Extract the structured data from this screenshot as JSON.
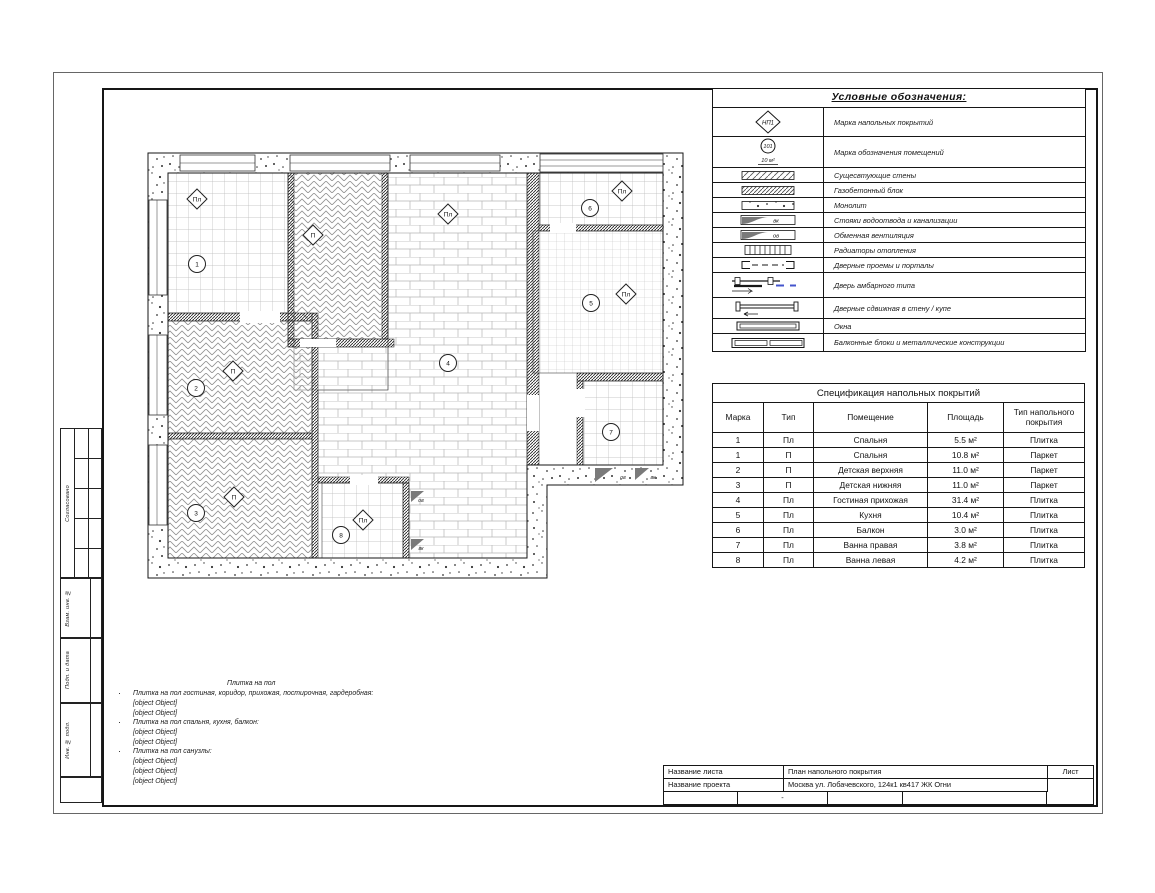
{
  "legend": {
    "title": "Условные обозначения:",
    "rows": [
      {
        "symbol": "floor-mark",
        "sym_text": "НП1",
        "label": "Марка напольных покрытий"
      },
      {
        "symbol": "room-mark",
        "sym_text": "101",
        "sym_sub": "10 м²",
        "label": "Марка обозначения помещений"
      },
      {
        "symbol": "existing-walls",
        "label": "Сущесвтующие стены"
      },
      {
        "symbol": "gas-block",
        "label": "Газобетонный блок"
      },
      {
        "symbol": "monolith",
        "label": "Монолит"
      },
      {
        "symbol": "water-stack",
        "sym_text": "вк",
        "label": "Стояки водоотвода и канализации"
      },
      {
        "symbol": "vent",
        "sym_text": "ов",
        "label": "Обменная вентиляция"
      },
      {
        "symbol": "radiator",
        "label": "Радиаторы отопления"
      },
      {
        "symbol": "door-opening",
        "label": "Дверные проемы и порталы"
      },
      {
        "symbol": "barn-door",
        "label": "Дверь амбарного типа"
      },
      {
        "symbol": "sliding-door",
        "label": "Дверные сдвижная в стену / купе"
      },
      {
        "symbol": "window",
        "label": "Окна"
      },
      {
        "symbol": "balcony-block",
        "label": "Балконные блоки и металлические конструкции"
      }
    ]
  },
  "spec": {
    "title": "Спецификация напольных покрытий",
    "headers": [
      "Марка",
      "Тип",
      "Помещение",
      "Площадь",
      "Тип напольного покрытия"
    ],
    "rows": [
      [
        "1",
        "Пл",
        "Спальня",
        "5.5 м²",
        "Плитка"
      ],
      [
        "1",
        "П",
        "Спальня",
        "10.8 м²",
        "Паркет"
      ],
      [
        "2",
        "П",
        "Детская верхняя",
        "11.0 м²",
        "Паркет"
      ],
      [
        "3",
        "П",
        "Детская нижняя",
        "11.0 м²",
        "Паркет"
      ],
      [
        "4",
        "Пл",
        "Гостиная прихожая",
        "31.4 м²",
        "Плитка"
      ],
      [
        "5",
        "Пл",
        "Кухня",
        "10.4 м²",
        "Плитка"
      ],
      [
        "6",
        "Пл",
        "Балкон",
        "3.0 м²",
        "Плитка"
      ],
      [
        "7",
        "Пл",
        "Ванна правая",
        "3.8 м²",
        "Плитка"
      ],
      [
        "8",
        "Пл",
        "Ванна левая",
        "4.2 м²",
        "Плитка"
      ]
    ]
  },
  "notes": {
    "title": "Плитка на пол",
    "items": [
      {
        "text": "Плитка на пол гостиная, коридор, прихожая, постирочная, гардеробная:",
        "lines": [
          "https://kerama-marazzi.com/catalog/gres/sg701390r/",
          "9 мм"
        ]
      },
      {
        "text": "Плитка на пол спальня, кухня, балкон:",
        "lines": [
          "https://plitkazavr.ru/Italon/Climb/Rope-60x60",
          "9 мм"
        ]
      },
      {
        "text": "Плитка на пол санузлы:",
        "lines": [
          "https://laparet.ru/collection/amber_keramogranit_bezhevyy_sg162700n_40_2kh40_2/",
          "https://creto.ru/produkt/keramogranit-urban-chrome-f-p-47x47-nr-mat-1",
          "8мм"
        ]
      }
    ]
  },
  "titleblock": {
    "sheet_label": "Название листа",
    "sheet_value": "План напольного покрытия",
    "project_label": "Название проекта",
    "project_value": "Москва ул. Лобачевского, 124к1 кв417 ЖК Огни",
    "list_label": "Лист",
    "dash": "-"
  },
  "stamp": {
    "sections": [
      "Согласовано",
      "Взам. инв. №",
      "Подп. и дата",
      "Инв. № подл."
    ]
  },
  "plan": {
    "markers": [
      {
        "shape": "diamond",
        "label": "Пл"
      },
      {
        "shape": "circle",
        "label": "1"
      },
      {
        "shape": "diamond",
        "label": "П"
      },
      {
        "shape": "diamond",
        "label": "Пл"
      },
      {
        "shape": "circle",
        "label": "4"
      },
      {
        "shape": "diamond",
        "label": "Пл"
      },
      {
        "shape": "circle",
        "label": "6"
      },
      {
        "shape": "circle",
        "label": "5"
      },
      {
        "shape": "diamond",
        "label": "Пл"
      },
      {
        "shape": "diamond",
        "label": "П"
      },
      {
        "shape": "circle",
        "label": "2"
      },
      {
        "shape": "diamond",
        "label": "П"
      },
      {
        "shape": "circle",
        "label": "3"
      },
      {
        "shape": "diamond",
        "label": "Пл"
      },
      {
        "shape": "circle",
        "label": "8"
      },
      {
        "shape": "circle",
        "label": "7"
      }
    ],
    "stacks": [
      "ов",
      "вк",
      "ов",
      "вк"
    ]
  },
  "colors": {
    "line": "#161616",
    "hatch": "#555555",
    "tile_grid": "#b9b9b9",
    "accent_blue": "#4455cc",
    "stack_grey": "#7a7a7a"
  }
}
